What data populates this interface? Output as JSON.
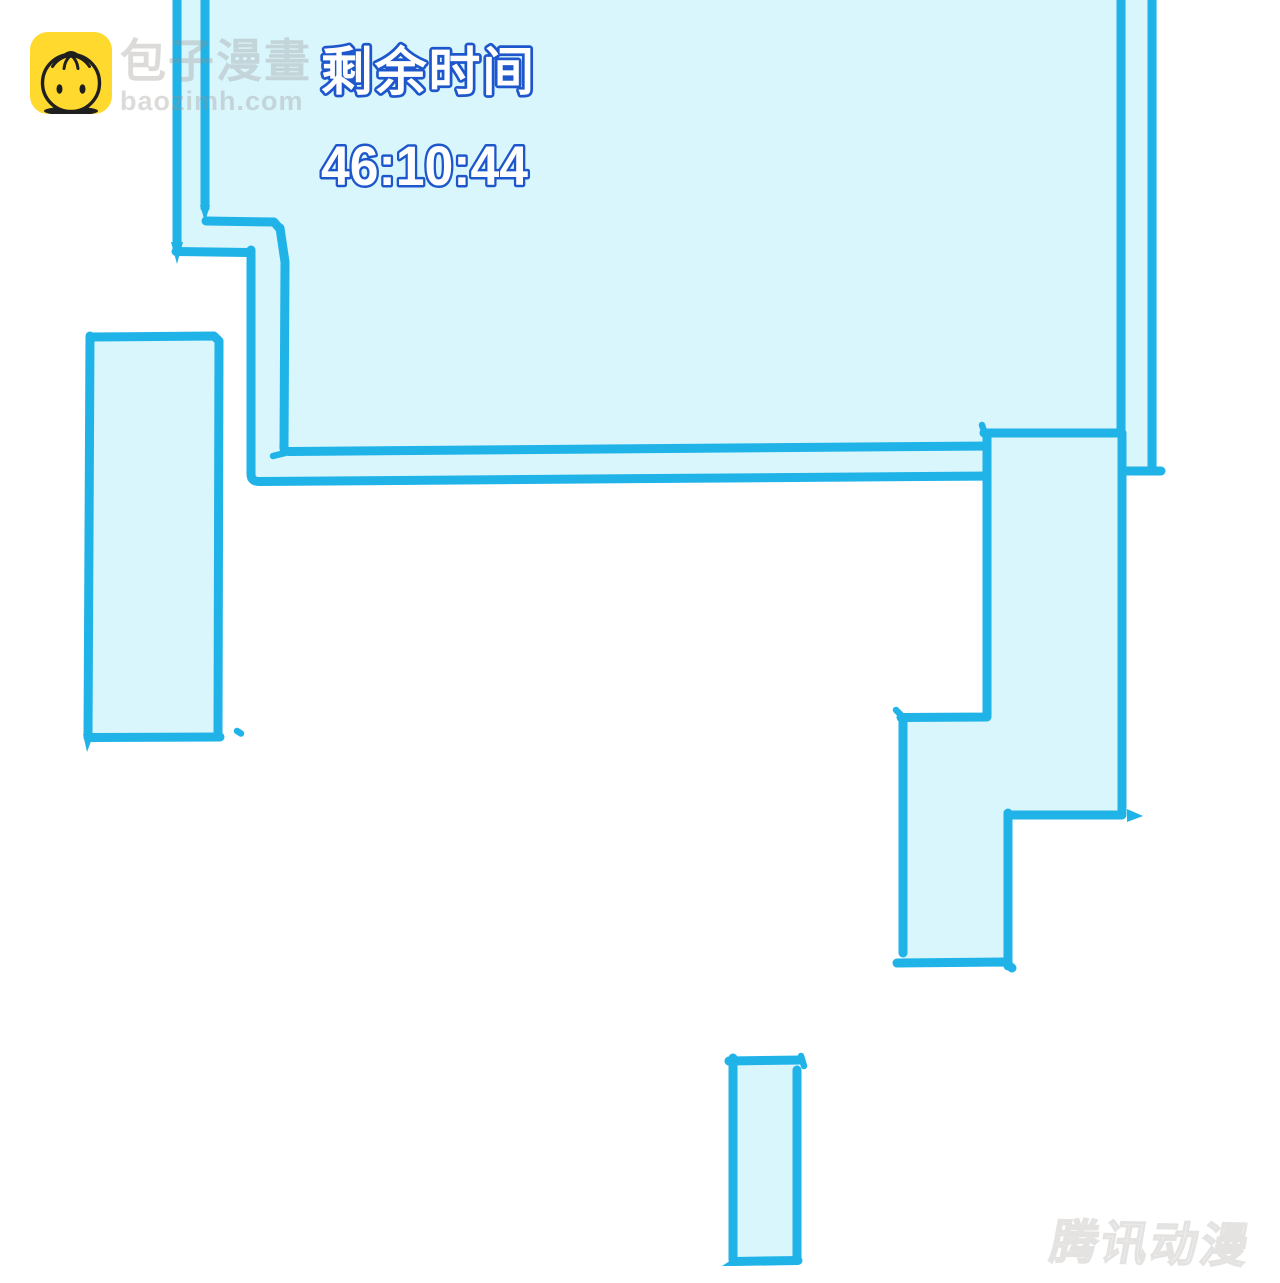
{
  "site_watermark": {
    "name": "包子漫畫",
    "domain": "baozimh.com"
  },
  "comic_panel": {
    "label": "剩余时间",
    "timer": "46:10:44"
  },
  "publisher_watermark": {
    "text": "腾讯动漫"
  },
  "colors": {
    "panel-border": "#1fb3e8",
    "panel-fill": "#d9f6fd",
    "timer-blue": "#1e57cb",
    "logo-yellow": "#ffd92e",
    "logo-ink": "#1f1f1f",
    "watermark-gray": "rgba(150,144,140,0.32)",
    "publisher-gray": "#e4e3e2"
  }
}
